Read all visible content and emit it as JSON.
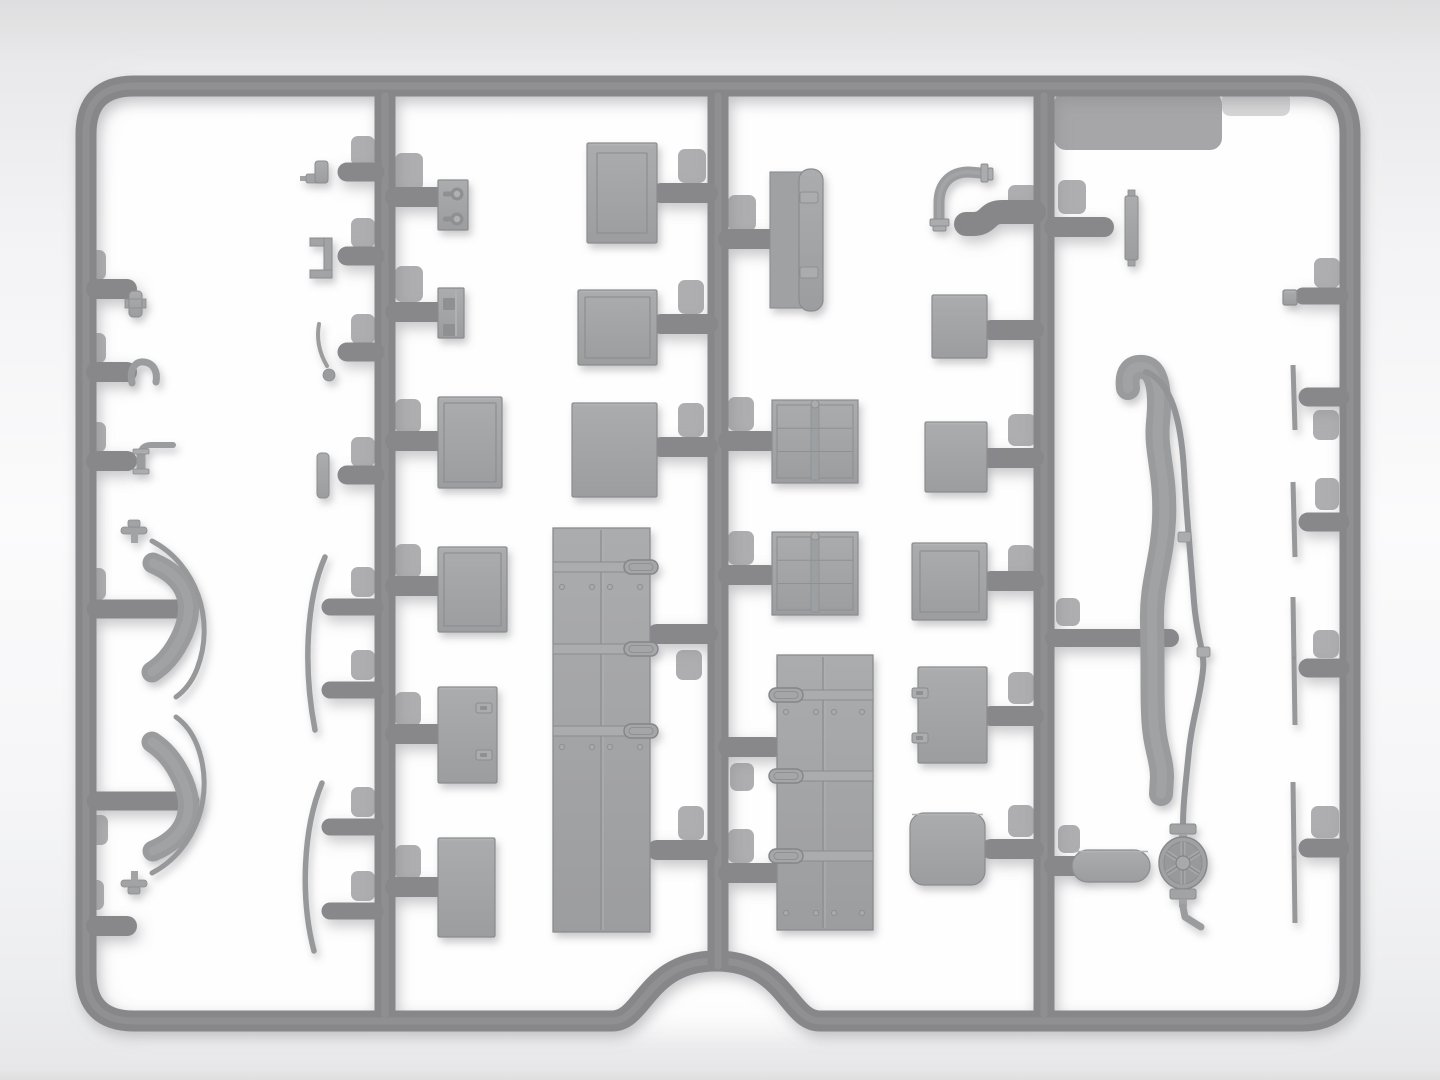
{
  "scene": {
    "kind": "model-kit-sprue-render",
    "canvas": {
      "width": 1440,
      "height": 1080
    },
    "palette": {
      "runner": "#87878a",
      "runner_hi": "#98989b",
      "part": "#a2a3a5",
      "part_light": "#abacae",
      "part_dark": "#8b8c8e",
      "detail_dark": "#8f9092",
      "tube": "#9b9c9e",
      "blade": "#97989a",
      "pad": "#aeaeb0",
      "band": "#a6a6a8",
      "glow": "#ffffff",
      "shadow": "#8a8a90"
    },
    "frame": {
      "path": "M 134 86 H 1302 Q 1350 86 1350 134 V 973 Q 1350 1021 1302 1021 H 820 C 788 1021 786 961 716 961 C 646 961 644 1021 612 1021 H 134 Q 86 1021 86 973 V 134 Q 86 86 134 86 Z",
      "stroke": 21
    },
    "glow_rect": [
      92,
      80,
      1262,
      952,
      55
    ],
    "runners": [
      {
        "name": "runner-a",
        "x": 385,
        "y1": 96,
        "y2": 1014
      },
      {
        "name": "runner-b",
        "x": 718,
        "y1": 96,
        "y2": 966
      },
      {
        "name": "runner-c",
        "x": 1044,
        "y1": 96,
        "y2": 1014
      }
    ],
    "branches": [
      {
        "name": "feeder-s-bend",
        "d": "M 1034 212 L 1002 212 C 986 212 990 224 972 224 L 966 224",
        "w": 24
      }
    ],
    "stubs": [
      [
        96,
        289,
        127,
        20
      ],
      [
        96,
        372,
        127,
        20
      ],
      [
        96,
        461,
        127,
        20
      ],
      [
        96,
        609,
        180,
        19
      ],
      [
        96,
        801,
        190,
        19
      ],
      [
        96,
        926,
        127,
        20
      ],
      [
        375,
        172,
        347,
        19
      ],
      [
        375,
        256,
        347,
        19
      ],
      [
        375,
        352,
        347,
        19
      ],
      [
        375,
        475,
        347,
        19
      ],
      [
        375,
        607,
        330,
        17
      ],
      [
        375,
        690,
        330,
        17
      ],
      [
        375,
        827,
        330,
        17
      ],
      [
        375,
        911,
        330,
        17
      ],
      [
        395,
        197,
        437,
        20
      ],
      [
        395,
        312,
        437,
        20
      ],
      [
        395,
        441,
        437,
        20
      ],
      [
        395,
        586,
        437,
        20
      ],
      [
        395,
        734,
        437,
        20
      ],
      [
        395,
        887,
        437,
        20
      ],
      [
        708,
        193,
        661,
        20
      ],
      [
        708,
        324,
        661,
        20
      ],
      [
        708,
        447,
        661,
        20
      ],
      [
        708,
        634,
        657,
        20
      ],
      [
        708,
        850,
        657,
        20
      ],
      [
        728,
        239,
        769,
        20
      ],
      [
        728,
        441,
        769,
        20
      ],
      [
        728,
        575,
        769,
        20
      ],
      [
        728,
        747,
        774,
        20
      ],
      [
        728,
        873,
        774,
        20
      ],
      [
        1034,
        330,
        991,
        20
      ],
      [
        1034,
        458,
        989,
        20
      ],
      [
        1034,
        581,
        991,
        20
      ],
      [
        1034,
        716,
        991,
        20
      ],
      [
        1034,
        849,
        991,
        20
      ],
      [
        1054,
        227,
        1104,
        20
      ],
      [
        1054,
        638,
        1170,
        18
      ],
      [
        1054,
        866,
        1080,
        20
      ],
      [
        1340,
        296,
        1303,
        17
      ],
      [
        1340,
        397,
        1308,
        19
      ],
      [
        1340,
        522,
        1308,
        19
      ],
      [
        1340,
        668,
        1308,
        19
      ],
      [
        1340,
        848,
        1308,
        19
      ]
    ],
    "pads": [
      [
        84,
        250,
        22,
        30
      ],
      [
        84,
        333,
        22,
        30
      ],
      [
        84,
        422,
        22,
        30
      ],
      [
        82,
        568,
        24,
        32
      ],
      [
        84,
        815,
        24,
        30
      ],
      [
        82,
        880,
        22,
        30
      ],
      [
        351,
        136,
        24,
        30
      ],
      [
        351,
        218,
        24,
        30
      ],
      [
        351,
        314,
        24,
        30
      ],
      [
        351,
        437,
        24,
        30
      ],
      [
        351,
        567,
        24,
        30
      ],
      [
        351,
        650,
        24,
        30
      ],
      [
        351,
        787,
        24,
        30
      ],
      [
        351,
        871,
        24,
        30
      ],
      [
        395,
        153,
        28,
        38
      ],
      [
        395,
        266,
        28,
        36
      ],
      [
        395,
        399,
        26,
        34
      ],
      [
        395,
        544,
        26,
        34
      ],
      [
        395,
        692,
        26,
        34
      ],
      [
        395,
        845,
        26,
        34
      ],
      [
        678,
        149,
        28,
        34
      ],
      [
        678,
        280,
        26,
        34
      ],
      [
        678,
        403,
        26,
        34
      ],
      [
        676,
        650,
        26,
        30
      ],
      [
        678,
        806,
        26,
        34
      ],
      [
        728,
        195,
        28,
        36
      ],
      [
        728,
        397,
        26,
        34
      ],
      [
        728,
        531,
        26,
        34
      ],
      [
        730,
        763,
        24,
        28
      ],
      [
        728,
        829,
        26,
        34
      ],
      [
        1008,
        185,
        30,
        34
      ],
      [
        1008,
        414,
        28,
        32
      ],
      [
        1008,
        545,
        26,
        32
      ],
      [
        1008,
        672,
        26,
        32
      ],
      [
        1008,
        805,
        26,
        32
      ],
      [
        1058,
        180,
        28,
        34
      ],
      [
        1056,
        598,
        24,
        28
      ],
      [
        1058,
        825,
        22,
        28
      ],
      [
        1314,
        258,
        26,
        30
      ],
      [
        1313,
        410,
        26,
        30
      ],
      [
        1315,
        478,
        24,
        32
      ],
      [
        1313,
        630,
        26,
        28
      ],
      [
        1311,
        806,
        28,
        32
      ]
    ],
    "bands": [
      {
        "rect": [
          1054,
          92,
          168,
          58,
          12
        ],
        "opacity": 1
      },
      {
        "rect": [
          1222,
          92,
          68,
          24,
          8
        ],
        "opacity": 0.45
      }
    ],
    "parts": [
      {
        "name": "coupling-small",
        "type": "coupling",
        "x": 129,
        "y": 291,
        "w": 13,
        "h": 26
      },
      {
        "name": "u-tube-hook",
        "type": "hook",
        "d": "M 132 383 C 129 368 136 361 144 362 C 153 363 158 371 156 382",
        "w": 7
      },
      {
        "name": "elbow-pipe-small",
        "type": "elbow_l",
        "hx1": 148,
        "hx2": 173,
        "hy": 445,
        "vx": 141,
        "vy1": 449,
        "vy2": 471
      },
      {
        "name": "curved-brace-top",
        "type": "saber",
        "thick": "M 153 563 C 186 577 196 602 183 633 C 173 656 161 666 152 672",
        "blade": "M 152 541 C 196 564 216 620 197 669 C 191 684 183 692 176 697",
        "bar": [
          121,
          527,
          26,
          7
        ],
        "stem": [
          131,
          533,
          7,
          10
        ],
        "knob": [
          128,
          520,
          12,
          7
        ]
      },
      {
        "name": "curved-brace-bottom",
        "type": "saber",
        "thick": "M 153 851 C 186 837 196 812 183 781 C 173 758 161 748 152 742",
        "blade": "M 152 873 C 196 850 216 794 197 745 C 191 730 183 722 176 717",
        "bar": [
          121,
          880,
          26,
          7
        ],
        "stem": [
          131,
          871,
          7,
          10
        ],
        "knob": [
          128,
          887,
          12,
          7
        ]
      },
      {
        "name": "filler-cap",
        "type": "cap_fitting",
        "base": [
          306,
          174,
          14,
          9
        ],
        "cyl": [
          315,
          161,
          13,
          22
        ],
        "pin": [
          300,
          176,
          7,
          5
        ]
      },
      {
        "name": "u-bracket",
        "type": "u_bracket",
        "rects": [
          [
            310,
            238,
            22,
            8
          ],
          [
            324,
            238,
            8,
            40
          ],
          [
            310,
            270,
            22,
            8
          ]
        ]
      },
      {
        "name": "bent-rod-lever",
        "type": "bent_rod",
        "d": "M 319 324 C 316 340 320 354 327 366",
        "ball": [
          329,
          375,
          6
        ]
      },
      {
        "name": "small-strip",
        "type": "strip",
        "rect": [
          317,
          453,
          12,
          45,
          4
        ]
      },
      {
        "name": "thin-curved-blade-1",
        "type": "thin_blade",
        "d": "M 325 557 C 306 600 303 668 315 730",
        "w": 5.5
      },
      {
        "name": "thin-curved-blade-2",
        "type": "thin_blade",
        "d": "M 322 783 C 303 828 300 898 314 951",
        "w": 5.5
      },
      {
        "name": "keyhole-plate",
        "type": "keyhole_plate",
        "rect": [
          438,
          180,
          30,
          50
        ],
        "holes": [
          [
            457,
            194
          ],
          [
            457,
            219
          ]
        ]
      },
      {
        "name": "squarehole-plate",
        "type": "squarehole_plate",
        "rect": [
          438,
          288,
          26,
          50
        ],
        "holes": [
          [
            441,
            296
          ],
          [
            441,
            322
          ]
        ],
        "ridge": 456
      },
      {
        "name": "panel-a",
        "type": "panel",
        "rect": [
          438,
          397,
          64,
          91
        ],
        "inset": 6
      },
      {
        "name": "panel-b",
        "type": "panel",
        "rect": [
          438,
          547,
          69,
          85
        ],
        "inset": 6
      },
      {
        "name": "latch-panel-left",
        "type": "latch_panel",
        "rect": [
          438,
          687,
          59,
          96
        ],
        "latches": [
          [
            476,
            703
          ],
          [
            476,
            750
          ]
        ]
      },
      {
        "name": "panel-c",
        "type": "panel",
        "rect": [
          438,
          838,
          57,
          99
        ],
        "inset": 0
      },
      {
        "name": "door-panel",
        "type": "panel",
        "rect": [
          587,
          143,
          70,
          100
        ],
        "inset": 10
      },
      {
        "name": "square-panel-2",
        "type": "panel",
        "rect": [
          578,
          290,
          79,
          75
        ],
        "inset": 7
      },
      {
        "name": "square-panel-3",
        "type": "panel",
        "rect": [
          572,
          403,
          85,
          94
        ],
        "inset": 0
      },
      {
        "name": "long-door-right-hinges",
        "type": "long_door",
        "rect": [
          553,
          528,
          97,
          404
        ],
        "seam": 601,
        "straps": [
          567,
          649,
          731
        ],
        "hinge": "right",
        "rivets": [
          {
            "y": 587,
            "xs": [
              562,
              592,
              610,
              640
            ]
          },
          {
            "y": 747,
            "xs": [
              562,
              592,
              610,
              640
            ]
          }
        ]
      },
      {
        "name": "tarp-roll",
        "type": "tarp_roll",
        "plate": [
          770,
          172,
          34,
          136
        ],
        "roll": [
          799,
          169,
          24,
          142
        ],
        "straps": [
          [
            800,
            192,
            18,
            11
          ],
          [
            800,
            267,
            18,
            11
          ]
        ]
      },
      {
        "name": "crate-1",
        "type": "crate",
        "rect": [
          772,
          400,
          86,
          83
        ]
      },
      {
        "name": "crate-2",
        "type": "crate",
        "rect": [
          772,
          532,
          86,
          83
        ]
      },
      {
        "name": "long-door-left-hinges",
        "type": "long_door",
        "rect": [
          777,
          655,
          96,
          275
        ],
        "seam": 823,
        "straps": [
          695,
          776,
          856
        ],
        "hinge": "left",
        "rivets": [
          {
            "y": 712,
            "xs": [
              786,
              816,
              834,
              862
            ]
          },
          {
            "y": 913,
            "xs": [
              786,
              816,
              834,
              862
            ]
          }
        ]
      },
      {
        "name": "box-a",
        "type": "panel",
        "rect": [
          932,
          295,
          55,
          63
        ],
        "inset": 0
      },
      {
        "name": "box-b",
        "type": "panel",
        "rect": [
          925,
          422,
          62,
          70
        ],
        "inset": 0
      },
      {
        "name": "box-c",
        "type": "panel",
        "rect": [
          912,
          543,
          75,
          77
        ],
        "inset": 8
      },
      {
        "name": "latch-panel-right",
        "type": "latch_panel",
        "rect": [
          918,
          667,
          69,
          96
        ],
        "latches": [
          [
            912,
            688
          ],
          [
            912,
            733
          ]
        ]
      },
      {
        "name": "rounded-box",
        "type": "panel",
        "rect": [
          910,
          813,
          75,
          72
        ],
        "inset": 0,
        "rx": 14
      },
      {
        "name": "flanged-elbow-pipe",
        "type": "elbow_pipe",
        "d": "M 939 224 L 939 203 C 939 183 951 172 969 172 L 981 173",
        "f1": [
          [
            930,
            219,
            19,
            7
          ],
          [
            933,
            226,
            13,
            5
          ]
        ],
        "f2": [
          [
            981,
            164,
            7,
            18
          ],
          [
            988,
            168,
            5,
            12
          ]
        ]
      },
      {
        "name": "hinge-strip",
        "type": "strip_tabs",
        "rect": [
          1125,
          196,
          13,
          64
        ],
        "tabs": [
          [
            1128,
            190,
            7,
            6
          ],
          [
            1128,
            260,
            7,
            6
          ]
        ]
      },
      {
        "name": "thick-hose",
        "type": "hose",
        "d": "M 1128 388 C 1126 372 1132 366 1143 367 C 1158 369 1161 392 1158 422 C 1155 452 1166 472 1164 520 C 1162 562 1151 582 1152 622 C 1153 662 1152 692 1153 712 C 1154 748 1162 757 1162 777 L 1161 794",
        "w": 24
      },
      {
        "name": "fuel-line",
        "type": "cable",
        "d": "M 1146 372 C 1172 382 1181 422 1184 470 C 1187 520 1191 562 1194 602 C 1197 640 1205 652 1203 670 C 1200 700 1191 722 1188 760 C 1185 790 1183 806 1183 826",
        "collars": [
          [
            1178,
            532,
            13,
            10
          ],
          [
            1197,
            647,
            13,
            10
          ]
        ]
      },
      {
        "name": "valve-handwheel",
        "type": "valve_wheel",
        "cx": 1183,
        "cy": 863,
        "rx": 24,
        "ry": 26,
        "top_flange": [
          1170,
          824,
          26,
          10
        ],
        "top_stem": [
          1179,
          834,
          8,
          10
        ],
        "bot_flange": [
          1170,
          889,
          26,
          10
        ],
        "bot_stem": [
          1179,
          899,
          8,
          8
        ],
        "tail": "M 1183 907 L 1185 917 L 1201 927"
      },
      {
        "name": "pill-muffler",
        "type": "panel",
        "rect": [
          1072,
          850,
          78,
          32
        ],
        "inset": 0,
        "rx": 16
      },
      {
        "name": "small-square",
        "type": "panel",
        "rect": [
          1283,
          290,
          14,
          15
        ],
        "inset": 0,
        "rx": 2
      },
      {
        "name": "edge-blade-a",
        "type": "edge_blade",
        "x1": 1293,
        "y1": 365,
        "x2": 1295,
        "y2": 430,
        "dots": []
      },
      {
        "name": "edge-blade-b",
        "type": "edge_blade",
        "x1": 1293,
        "y1": 482,
        "x2": 1295,
        "y2": 557,
        "dots": []
      },
      {
        "name": "edge-blade-c",
        "type": "edge_blade",
        "x1": 1293,
        "y1": 597,
        "x2": 1295,
        "y2": 725,
        "dots": [
          [
            1294,
            658
          ]
        ]
      },
      {
        "name": "edge-blade-d",
        "type": "edge_blade",
        "x1": 1293,
        "y1": 782,
        "x2": 1295,
        "y2": 923,
        "dots": [
          [
            1294,
            857
          ]
        ]
      }
    ]
  }
}
